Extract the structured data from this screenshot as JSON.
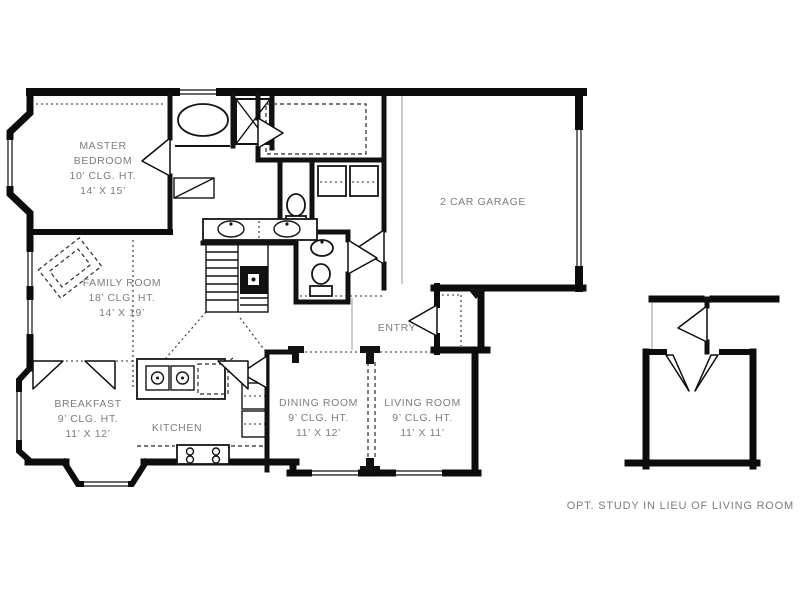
{
  "title": "First floor plan",
  "colors": {
    "background": "#ffffff",
    "wall": "#0c0c0c",
    "label_text": "#7d7d7d",
    "thin_line": "#9a9a9a",
    "dashed_line": "#2b2b2b"
  },
  "rooms": [
    {
      "id": "master-bedroom",
      "lines": [
        "MASTER",
        "BEDROOM",
        "10’ CLG. HT.",
        "14’ X 15’"
      ]
    },
    {
      "id": "family-room",
      "lines": [
        "FAMILY ROOM",
        "18’ CLG. HT.",
        "14’ X 19’"
      ]
    },
    {
      "id": "breakfast",
      "lines": [
        "BREAKFAST",
        "9’ CLG. HT.",
        "11’ X 12’"
      ]
    },
    {
      "id": "kitchen",
      "lines": [
        "KITCHEN"
      ]
    },
    {
      "id": "dining-room",
      "lines": [
        "DINING ROOM",
        "9’ CLG. HT.",
        "11’ X 12’"
      ]
    },
    {
      "id": "living-room",
      "lines": [
        "LIVING ROOM",
        "9’ CLG. HT.",
        "11’ X 11’"
      ]
    },
    {
      "id": "garage",
      "lines": [
        "2 CAR GARAGE"
      ]
    },
    {
      "id": "entry",
      "lines": [
        "ENTRY"
      ]
    }
  ],
  "caption": "OPT. STUDY IN LIEU OF LIVING ROOM",
  "icons": [
    "bathtub-icon",
    "shower-icon",
    "toilet-icon",
    "sink-icon",
    "double-vanity-icon",
    "washer-dryer-icon",
    "kitchen-island-sink-icon",
    "range-cooktop-icon",
    "staircase-icon",
    "door-swing-icon",
    "fireplace-icon",
    "window-icon",
    "french-doors-icon",
    "column-icon"
  ]
}
